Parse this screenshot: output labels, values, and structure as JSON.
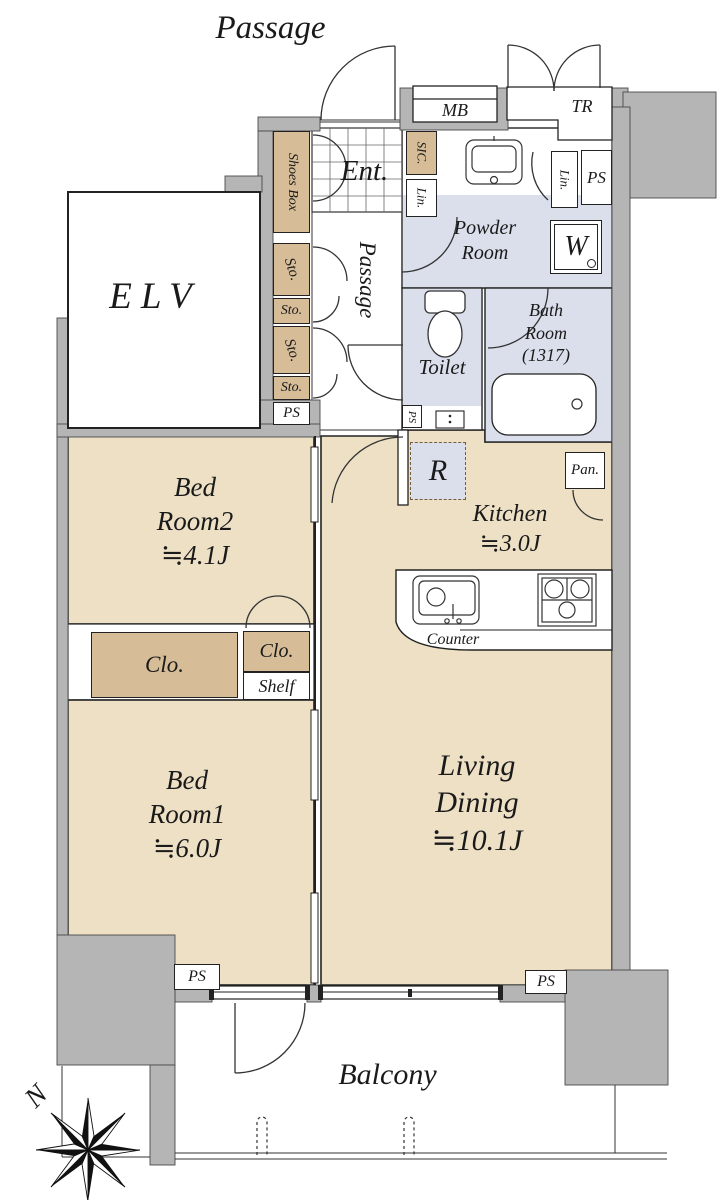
{
  "plan": {
    "corridor_label": "Passage",
    "compass": {
      "north": "N"
    },
    "rooms": {
      "elv": "ELV",
      "entrance": "Ent.",
      "hall": "Passage",
      "powder": [
        "Powder",
        "Room"
      ],
      "toilet": "Toilet",
      "bath": [
        "Bath",
        "Room",
        "(1317)"
      ],
      "kitchen": [
        "Kitchen",
        "≒3.0J"
      ],
      "bed2": [
        "Bed",
        "Room2",
        "≒4.1J"
      ],
      "bed1": [
        "Bed",
        "Room1",
        "≒6.0J"
      ],
      "living": [
        "Living",
        "Dining",
        "≒10.1J"
      ],
      "balcony": "Balcony"
    },
    "fixtures": {
      "shoes_box": "Shoes Box",
      "mb": "MB",
      "tr": "TR",
      "sic": "SIC.",
      "lin_hall": "Lin.",
      "lin_powder": "Lin.",
      "ps_powder": "PS",
      "ps_column": "PS",
      "ps_toilet": "PS",
      "ps_bed1": "PS",
      "ps_living": "PS",
      "washer": "W",
      "sto_1": "Sto.",
      "sto_2": "Sto.",
      "sto_3": "Sto.",
      "sto_4": "Sto.",
      "pan": "Pan.",
      "fridge": "R",
      "clo_bed2": "Clo.",
      "clo_hall": "Clo.",
      "shelf": "Shelf",
      "counter": "Counter"
    },
    "colors": {
      "floor_tan": "#ede0c4",
      "closet_tan": "#d6bd98",
      "wet_blue": "#dbdfec",
      "wall_gray": "#b5b5b5",
      "line": "#222222"
    }
  }
}
